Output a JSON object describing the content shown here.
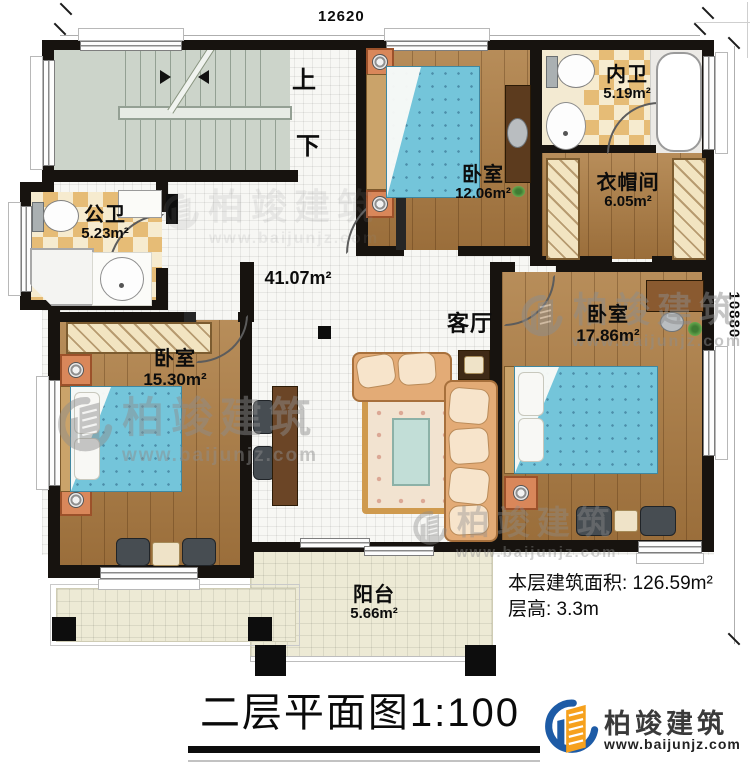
{
  "dimensions": {
    "top": "12620",
    "right": "10880"
  },
  "stairs": {
    "up_label": "上",
    "down_label": "下"
  },
  "rooms": [
    {
      "name": "卧室",
      "area": "12.06m²"
    },
    {
      "name": "内卫",
      "area": "5.19m²"
    },
    {
      "name": "衣帽间",
      "area": "6.05m²"
    },
    {
      "name": "公卫",
      "area": "5.23m²"
    },
    {
      "name": "客厅",
      "area": "41.07m²"
    },
    {
      "name": "卧室",
      "area": "15.30m²"
    },
    {
      "name": "卧室",
      "area": "17.86m²"
    },
    {
      "name": "阳台",
      "area": "5.66m²"
    }
  ],
  "notes": {
    "floor_area": "本层建筑面积: 126.59m²",
    "floor_height": "层高: 3.3m"
  },
  "title": "二层平面图1:100",
  "watermark": {
    "name": "柏竣建筑",
    "website": "www.baijunjz.com"
  },
  "brand": {
    "name": "柏竣建筑",
    "website": "www.baijunjz.com"
  },
  "colors": {
    "wall": "#17130f",
    "wood": "#a87a44",
    "bath_tile": "#e6bc76",
    "living_tile": "#f7f7f4",
    "balcony_tile": "#edead5",
    "stair": "#ccd4ca",
    "bed": "#74c5da",
    "logo_blue": "#1d5ba6",
    "logo_orange": "#f6a11d"
  }
}
